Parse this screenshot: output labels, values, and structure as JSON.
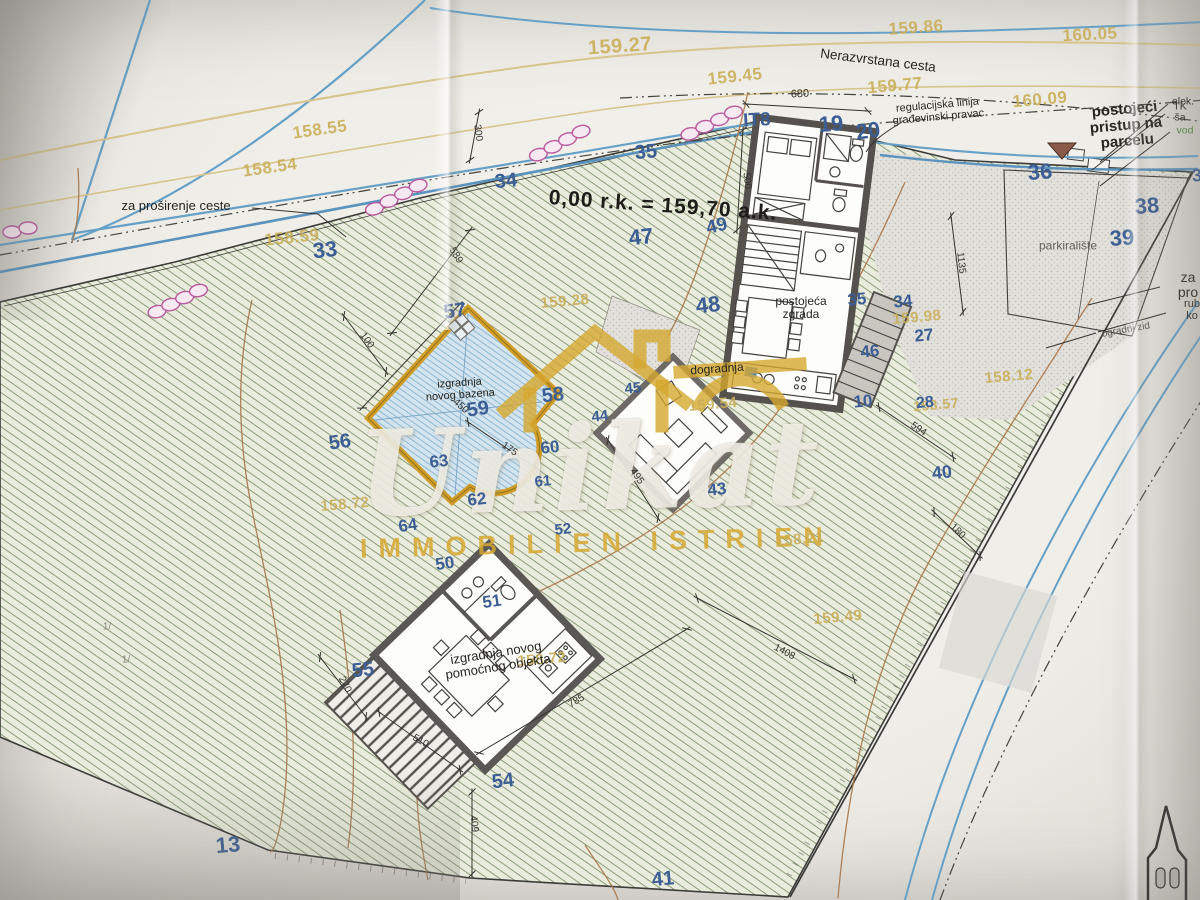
{
  "datum": {
    "text": "0,00 r.k.  =  159,70 a.k."
  },
  "watermark": {
    "name": "Unikat",
    "tagline": "IMMOBILIEN ISTRIEN"
  },
  "colors": {
    "parcel_number": "#3c5e94",
    "elevation": "#c9ae57",
    "watermark_gold": "#d6a830",
    "road_blue": "#66a0c6",
    "contour_brown": "#a8764a",
    "pool_gold": "#cf9c28"
  },
  "labels": {
    "elevations": [
      {
        "text": "159.27",
        "x": 620,
        "y": 47,
        "r": -4,
        "fs": 20
      },
      {
        "text": "159.86",
        "x": 916,
        "y": 28,
        "r": -4,
        "fs": 17
      },
      {
        "text": "160.05",
        "x": 1090,
        "y": 35,
        "r": -3,
        "fs": 17
      },
      {
        "text": "159.45",
        "x": 735,
        "y": 77,
        "r": -6,
        "fs": 17
      },
      {
        "text": "159.77",
        "x": 895,
        "y": 86,
        "r": -5,
        "fs": 17
      },
      {
        "text": "160.09",
        "x": 1040,
        "y": 100,
        "r": -5,
        "fs": 17
      },
      {
        "text": "158.55",
        "x": 320,
        "y": 130,
        "r": -8,
        "fs": 17
      },
      {
        "text": "158.54",
        "x": 270,
        "y": 168,
        "r": -8,
        "fs": 17
      },
      {
        "text": "158.59",
        "x": 292,
        "y": 238,
        "r": -6,
        "fs": 17
      },
      {
        "text": "159.28",
        "x": 565,
        "y": 302,
        "r": -5,
        "fs": 15
      },
      {
        "text": "159.98",
        "x": 917,
        "y": 318,
        "r": -5,
        "fs": 15
      },
      {
        "text": "158.12",
        "x": 1009,
        "y": 377,
        "r": -5,
        "fs": 15
      },
      {
        "text": "159.54",
        "x": 713,
        "y": 405,
        "r": -5,
        "fs": 15
      },
      {
        "text": "158.57",
        "x": 936,
        "y": 405,
        "r": -5,
        "fs": 14
      },
      {
        "text": "158.72",
        "x": 345,
        "y": 505,
        "r": -5,
        "fs": 15
      },
      {
        "text": "158.21",
        "x": 800,
        "y": 540,
        "r": -5,
        "fs": 15
      },
      {
        "text": "158.72",
        "x": 542,
        "y": 660,
        "r": -5,
        "fs": 15
      },
      {
        "text": "159.49",
        "x": 838,
        "y": 618,
        "r": -5,
        "fs": 15
      }
    ],
    "parcels": [
      {
        "text": "35",
        "x": 646,
        "y": 153,
        "fs": 20,
        "r": -5
      },
      {
        "text": "34",
        "x": 506,
        "y": 182,
        "fs": 20,
        "r": -5
      },
      {
        "text": "33",
        "x": 325,
        "y": 250,
        "fs": 22,
        "r": -6
      },
      {
        "text": "47",
        "x": 641,
        "y": 237,
        "fs": 22,
        "r": -6
      },
      {
        "text": "49",
        "x": 717,
        "y": 227,
        "fs": 19,
        "r": -14
      },
      {
        "text": "48",
        "x": 708,
        "y": 305,
        "fs": 22,
        "r": -6
      },
      {
        "text": "19",
        "x": 831,
        "y": 124,
        "fs": 22,
        "r": -4
      },
      {
        "text": "20",
        "x": 868,
        "y": 131,
        "fs": 22,
        "r": -8
      },
      {
        "text": "IT8",
        "x": 757,
        "y": 121,
        "fs": 19,
        "r": -3
      },
      {
        "text": "36",
        "x": 1040,
        "y": 172,
        "fs": 22,
        "r": -4
      },
      {
        "text": "38",
        "x": 1147,
        "y": 206,
        "fs": 22,
        "r": -4
      },
      {
        "text": "39",
        "x": 1122,
        "y": 238,
        "fs": 22,
        "r": -4
      },
      {
        "text": "3",
        "x": 1197,
        "y": 176,
        "fs": 18,
        "r": -4
      },
      {
        "text": "35",
        "x": 857,
        "y": 300,
        "fs": 17,
        "r": -5
      },
      {
        "text": "34",
        "x": 903,
        "y": 302,
        "fs": 17,
        "r": -5
      },
      {
        "text": "27",
        "x": 924,
        "y": 336,
        "fs": 17,
        "r": -5
      },
      {
        "text": "46",
        "x": 870,
        "y": 352,
        "fs": 17,
        "r": -5
      },
      {
        "text": "10",
        "x": 863,
        "y": 402,
        "fs": 17,
        "r": -5
      },
      {
        "text": "28",
        "x": 925,
        "y": 403,
        "fs": 16,
        "r": -5
      },
      {
        "text": "40",
        "x": 942,
        "y": 473,
        "fs": 18,
        "r": -6
      },
      {
        "text": "43",
        "x": 717,
        "y": 490,
        "fs": 17,
        "r": -6
      },
      {
        "text": "13",
        "x": 228,
        "y": 845,
        "fs": 22,
        "r": -5
      },
      {
        "text": "41",
        "x": 663,
        "y": 880,
        "fs": 20,
        "r": -5
      },
      {
        "text": "54",
        "x": 503,
        "y": 782,
        "fs": 20,
        "r": -6
      },
      {
        "text": "55",
        "x": 363,
        "y": 671,
        "fs": 20,
        "r": -6
      },
      {
        "text": "56",
        "x": 340,
        "y": 443,
        "fs": 20,
        "r": -8
      },
      {
        "text": "57",
        "x": 455,
        "y": 312,
        "fs": 20,
        "r": -8
      },
      {
        "text": "58",
        "x": 553,
        "y": 396,
        "fs": 20,
        "r": -6
      },
      {
        "text": "59",
        "x": 478,
        "y": 410,
        "fs": 20,
        "r": -8
      },
      {
        "text": "60",
        "x": 550,
        "y": 448,
        "fs": 17,
        "r": -6
      },
      {
        "text": "61",
        "x": 543,
        "y": 482,
        "fs": 15,
        "r": -6
      },
      {
        "text": "62",
        "x": 477,
        "y": 500,
        "fs": 17,
        "r": -6
      },
      {
        "text": "63",
        "x": 439,
        "y": 462,
        "fs": 17,
        "r": -6
      },
      {
        "text": "64",
        "x": 408,
        "y": 526,
        "fs": 17,
        "r": -8
      },
      {
        "text": "50",
        "x": 445,
        "y": 564,
        "fs": 17,
        "r": -8
      },
      {
        "text": "51",
        "x": 492,
        "y": 602,
        "fs": 17,
        "r": -8
      },
      {
        "text": "52",
        "x": 563,
        "y": 530,
        "fs": 15,
        "r": -6
      },
      {
        "text": "44",
        "x": 600,
        "y": 417,
        "fs": 15,
        "r": -6
      },
      {
        "text": "45",
        "x": 633,
        "y": 389,
        "fs": 15,
        "r": -6
      }
    ],
    "dimensions": [
      {
        "text": "680",
        "x": 800,
        "y": 95,
        "r": -3,
        "fs": 11
      },
      {
        "text": "300",
        "x": 477,
        "y": 133,
        "r": 82,
        "fs": 10
      },
      {
        "text": "500",
        "x": 746,
        "y": 181,
        "r": 84,
        "fs": 10
      },
      {
        "text": "589",
        "x": 455,
        "y": 256,
        "r": 58,
        "fs": 10
      },
      {
        "text": "100",
        "x": 366,
        "y": 341,
        "r": 54,
        "fs": 10
      },
      {
        "text": "450",
        "x": 460,
        "y": 407,
        "r": 42,
        "fs": 10
      },
      {
        "text": "175",
        "x": 509,
        "y": 450,
        "r": 35,
        "fs": 10
      },
      {
        "text": "495",
        "x": 636,
        "y": 477,
        "r": 55,
        "fs": 10
      },
      {
        "text": "1135",
        "x": 960,
        "y": 263,
        "r": 84,
        "fs": 10
      },
      {
        "text": "594",
        "x": 918,
        "y": 430,
        "r": 34,
        "fs": 10
      },
      {
        "text": "180",
        "x": 957,
        "y": 532,
        "r": 44,
        "fs": 10
      },
      {
        "text": "270",
        "x": 344,
        "y": 685,
        "r": 62,
        "fs": 10
      },
      {
        "text": "510",
        "x": 420,
        "y": 742,
        "r": 30,
        "fs": 10
      },
      {
        "text": "785",
        "x": 577,
        "y": 702,
        "r": -31,
        "fs": 10
      },
      {
        "text": "1408",
        "x": 784,
        "y": 653,
        "r": 28,
        "fs": 10
      },
      {
        "text": "409",
        "x": 473,
        "y": 824,
        "r": 84,
        "fs": 10
      }
    ],
    "notes": [
      {
        "text": "Nerazvrstana cesta",
        "x": 878,
        "y": 61,
        "r": 7,
        "fs": 13.5,
        "name": "road-name-label"
      },
      {
        "text": "regulacijska linija\ngrađevinski pravac",
        "x": 938,
        "y": 112,
        "r": -5,
        "fs": 11,
        "name": "regulation-line-label"
      },
      {
        "text": "postojeći pristup na\nparcelu",
        "x": 1126,
        "y": 126,
        "r": -5,
        "fs": 15,
        "cls": "semi",
        "name": "existing-access-label"
      },
      {
        "text": "elek.",
        "x": 1183,
        "y": 102,
        "r": 0,
        "fs": 10.5,
        "name": "electricity-label"
      },
      {
        "text": "TK ša",
        "x": 1180,
        "y": 113,
        "r": 0,
        "fs": 10.5,
        "name": "telecom-label"
      },
      {
        "text": "vod",
        "x": 1185,
        "y": 131,
        "r": 0,
        "fs": 10.5,
        "color": "#4e8a3e",
        "name": "water-label"
      },
      {
        "text": "za proširenje ceste",
        "x": 176,
        "y": 206,
        "r": 0,
        "fs": 13,
        "name": "road-widening-label"
      },
      {
        "text": "za pro",
        "x": 1188,
        "y": 285,
        "r": 0,
        "fs": 14,
        "name": "road-widening-label-right"
      },
      {
        "text": "rub ko",
        "x": 1192,
        "y": 311,
        "r": 0,
        "fs": 11,
        "name": "road-edge-label"
      },
      {
        "text": "ogradni zid",
        "x": 1126,
        "y": 331,
        "r": -10,
        "fs": 10,
        "color": "#55534e",
        "name": "fence-wall-label"
      },
      {
        "text": "parkiralište",
        "x": 1068,
        "y": 246,
        "r": 0,
        "fs": 12,
        "color": "#63615c",
        "name": "parking-label"
      },
      {
        "text": "postojeća\nzgrada",
        "x": 801,
        "y": 308,
        "r": 0,
        "fs": 12,
        "name": "existing-building-label"
      },
      {
        "text": "dogradnja",
        "x": 717,
        "y": 369,
        "r": -4,
        "fs": 12,
        "name": "extension-label"
      },
      {
        "text": "izgradnja\nnovog bazena",
        "x": 460,
        "y": 390,
        "r": -4,
        "fs": 11,
        "name": "new-pool-label"
      },
      {
        "text": "izgradnja novog\npomoćnog objekta",
        "x": 497,
        "y": 660,
        "r": -9,
        "fs": 13,
        "name": "new-auxiliary-building-label"
      },
      {
        "text": "1/",
        "x": 107,
        "y": 628,
        "r": 0,
        "fs": 10,
        "color": "#8a8780",
        "name": "terrain-mark"
      },
      {
        "text": "1/",
        "x": 126,
        "y": 661,
        "r": 0,
        "fs": 10,
        "color": "#8a8780",
        "name": "terrain-mark"
      }
    ]
  }
}
